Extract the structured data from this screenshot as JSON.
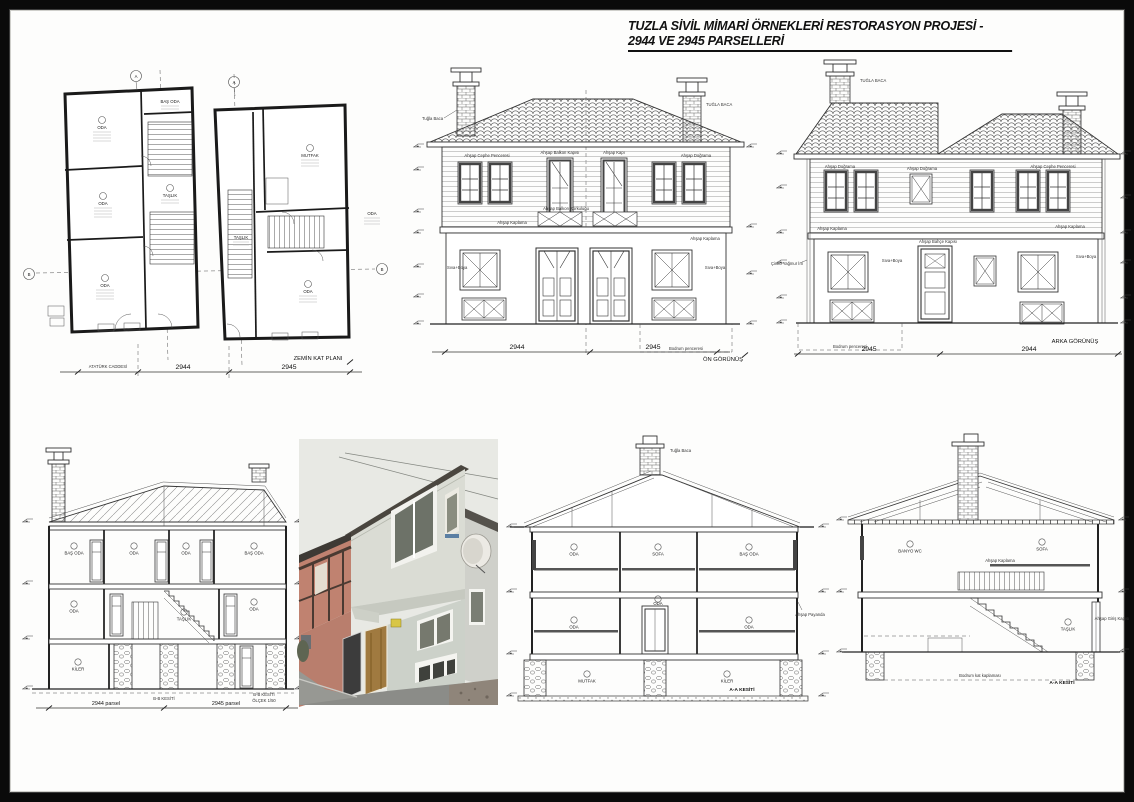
{
  "sheet": {
    "title": "TUZLA SİVİL MİMARİ ÖRNEKLERİ RESTORASYON PROJESİ - 2944 VE 2945 PARSELLERİ"
  },
  "plan": {
    "caption": "ZEMİN KAT PLANI",
    "street": "ATATÜRK CADDESİ",
    "dim_left": "2944",
    "dim_right": "2945",
    "axis_a": "A",
    "axis_b": "B",
    "rooms": {
      "oda1": "ODA",
      "oda2": "ODA",
      "oda3": "ODA",
      "bas_odasi": "BAŞ ODA",
      "taslik1": "TAŞLIK",
      "mutfak": "MUTFAK",
      "taslik2": "TAŞLIK",
      "oda4": "ODA",
      "oda5": "ODA"
    }
  },
  "front": {
    "caption": "ÖN GÖRÜNÜŞ",
    "dim_left": "2944",
    "dim_right": "2945",
    "ann_chimney": "Tuğla Baca",
    "ann_chimney2": "TUĞLA BACA",
    "ann_window": "Ahşap Cephe Penceresi",
    "ann_balcony": "Ahşap Balkon Kapısı",
    "ann_door": "Ahşap Kapı",
    "ann_railing": "Ahşap Balkon Korkuluğu",
    "ann_siding": "Ahşap Kaplama",
    "ann_trim": "Ahşap Doğrama",
    "ann_paint": "Sıva+Boya",
    "ann_basement": "Bodrum penceresi"
  },
  "rear": {
    "caption": "ARKA GÖRÜNÜŞ",
    "dim_left": "2945",
    "dim_right": "2944",
    "ann_chimney": "TUĞLA BACA",
    "ann_window": "Ahşap Cephe Penceresi",
    "ann_trim": "Ahşap Doğrama",
    "ann_door": "Ahşap Bahçe Kapısı",
    "ann_siding": "Ahşap Kaplama",
    "ann_paint": "Sıva+Boya",
    "ann_downpipe": "Çinko Yağmur İni",
    "ann_basement": "Bodrum penceresi"
  },
  "section_bb": {
    "caption": "B-B KESİTİ",
    "scale1": "B-B KESİTİ",
    "scale2": "ÖLÇEK 1/50",
    "dim_left": "2944 parsel",
    "dim_right": "2945 parsel",
    "rooms": {
      "r1": "BAŞ ODA",
      "r2": "ODA",
      "r3": "ODA",
      "r4": "BAŞ ODA",
      "r5": "ODA",
      "r6": "TAŞLIK",
      "r7": "ODA",
      "r8": "KİLER"
    }
  },
  "section_aa1": {
    "caption": "A-A KESİTİ",
    "ann_brace": "Ahşap Payanda",
    "ann_chimney": "Tuğla Baca",
    "rooms": {
      "r1": "ODA",
      "r2": "SOFA",
      "r3": "BAŞ ODA",
      "r4": "ODA",
      "r5": "ODA",
      "r6": "ODA",
      "r7": "MUTFAK",
      "r8": "KİLER"
    }
  },
  "section_aa2": {
    "caption": "A-A KESİTİ",
    "ann_basement": "Bodrum kat kaplaması",
    "ann_door": "Ahşap Giriş Kapısı",
    "ann_siding": "Ahşap Kaplama",
    "rooms": {
      "r1": "BANYO WC",
      "r2": "SOFA",
      "r3": "TAŞLIK"
    }
  }
}
